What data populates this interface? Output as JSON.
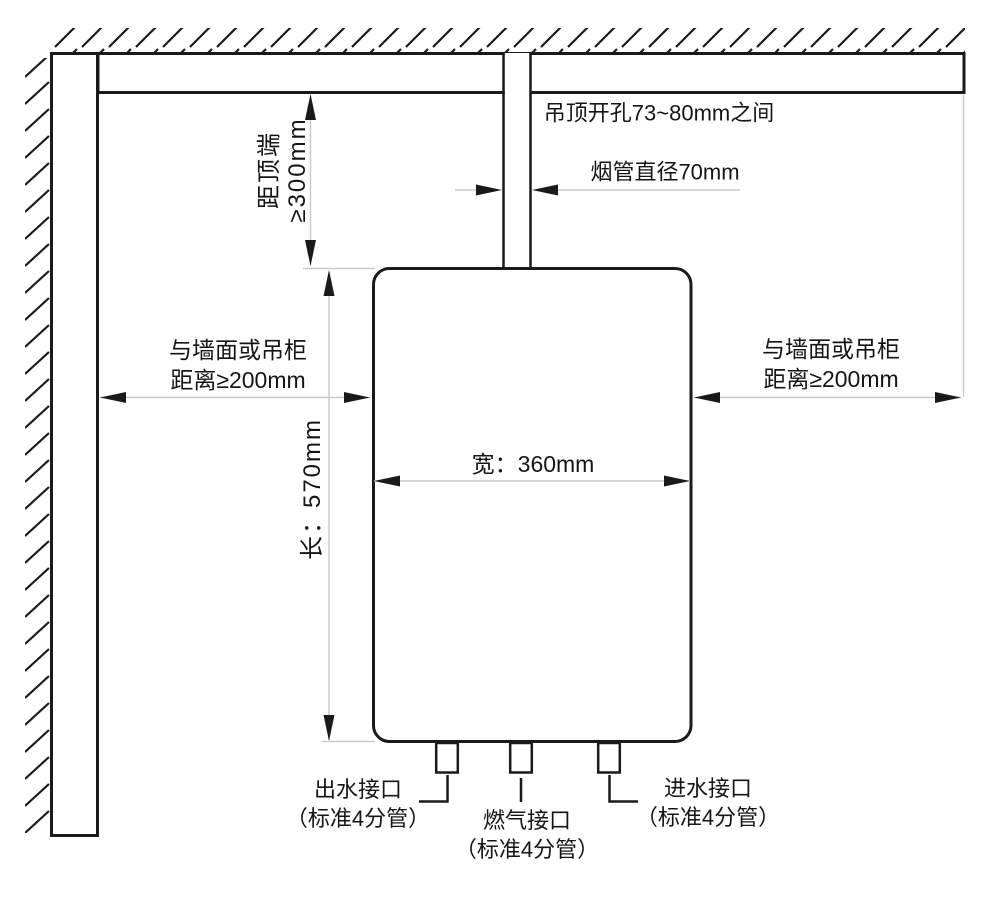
{
  "colors": {
    "line": "#1a1a1a",
    "dim_line": "#c9c9c9",
    "background": "#ffffff"
  },
  "labels": {
    "ceiling_opening": "吊顶开孔73~80mm之间",
    "flue_diameter": "烟管直径70mm",
    "top_clearance_line1": "距顶端",
    "top_clearance_line2": "≥300mm",
    "left_clearance_line1": "与墙面或吊柜",
    "left_clearance_line2": "距离≥200mm",
    "right_clearance_line1": "与墙面或吊柜",
    "right_clearance_line2": "距离≥200mm",
    "unit_height": "长：570mm",
    "unit_width": "宽：360mm",
    "outlet_line1": "出水接口",
    "outlet_line2": "（标准4分管）",
    "gas_line1": "燃气接口",
    "gas_line2": "（标准4分管）",
    "inlet_line1": "进水接口",
    "inlet_line2": "（标准4分管）"
  }
}
